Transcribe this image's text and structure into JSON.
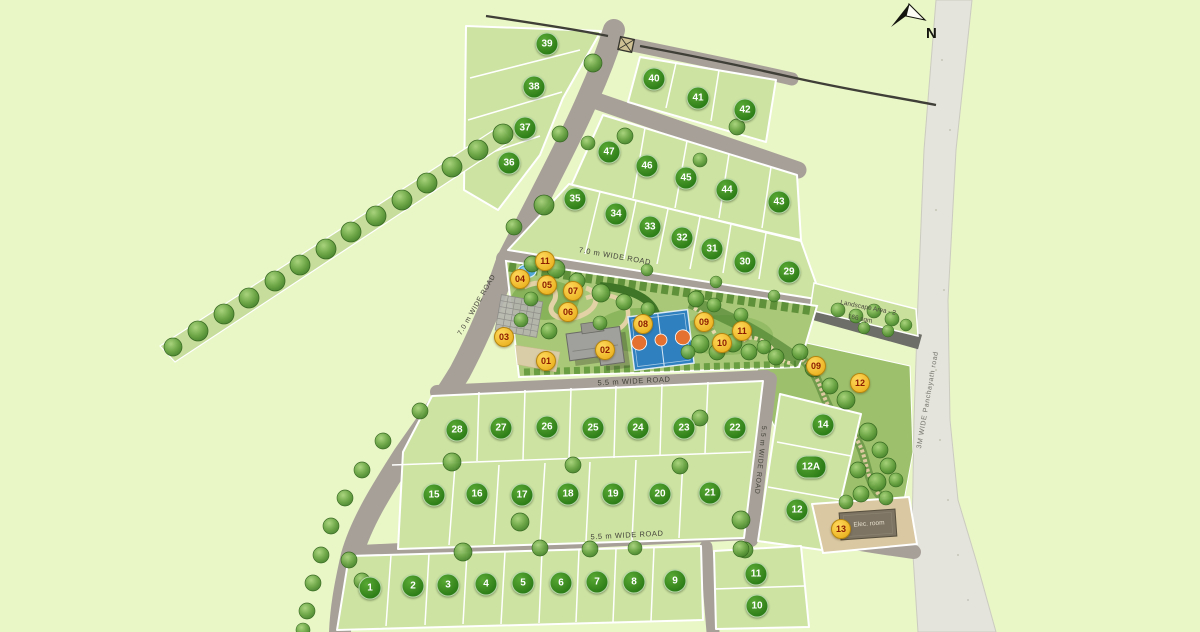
{
  "palette": {
    "background": "#e9f6c6",
    "plot_fill": "#cde3a2",
    "road_fill": "#a7a099",
    "ramp_road_fill": "#6e6e68",
    "panchayath_road_fill": "#e4e4dc",
    "garden_fill": "#a9c878",
    "plot_badge": "#2f8a1d",
    "plot_badge_text": "#ffffff",
    "amenity_badge": "#f0c02e",
    "amenity_badge_text": "#8c1c00",
    "court_blue": "#2f80bf",
    "court_orange": "#e4712f",
    "pond_blue": "#4ea7d8"
  },
  "north": {
    "label": "N"
  },
  "road_labels": [
    {
      "text": "7.0 m WIDE  ROAD",
      "x": 615,
      "y": 256,
      "rot": 10,
      "color": "#44443b",
      "size": 7.5
    },
    {
      "text": "7.0 m WIDE  ROAD",
      "x": 477,
      "y": 305,
      "rot": -60,
      "color": "#44443b",
      "size": 7
    },
    {
      "text": "5.5 m WIDE  ROAD",
      "x": 634,
      "y": 381,
      "rot": -3,
      "color": "#44443b",
      "size": 7.5
    },
    {
      "text": "5.5 m WIDE  ROAD",
      "x": 627,
      "y": 535,
      "rot": -3,
      "color": "#44443b",
      "size": 7.5
    },
    {
      "text": "5.5 m WIDE  ROAD",
      "x": 760,
      "y": 460,
      "rot": 96,
      "color": "#44443b",
      "size": 7
    },
    {
      "text": "3M WIDE  Panchayath road",
      "x": 928,
      "y": 400,
      "rot": -80,
      "color": "#73736b",
      "size": 7
    }
  ],
  "annotations": [
    {
      "text": "Landscape Area - 2",
      "x": 868,
      "y": 308,
      "rot": 11,
      "size": 6.5,
      "color": "#4c4a40"
    },
    {
      "text": "166 sqm",
      "x": 860,
      "y": 319,
      "rot": 11,
      "size": 6.5,
      "color": "#4c4a40"
    },
    {
      "text": "Elec. room",
      "x": 869,
      "y": 524,
      "rot": -4,
      "size": 6.5,
      "color": "#e6decd"
    }
  ],
  "plots": [
    {
      "n": "39",
      "x": 547,
      "y": 44
    },
    {
      "n": "38",
      "x": 534,
      "y": 87
    },
    {
      "n": "37",
      "x": 525,
      "y": 128
    },
    {
      "n": "36",
      "x": 509,
      "y": 163
    },
    {
      "n": "40",
      "x": 654,
      "y": 79
    },
    {
      "n": "41",
      "x": 698,
      "y": 98
    },
    {
      "n": "42",
      "x": 745,
      "y": 110
    },
    {
      "n": "47",
      "x": 609,
      "y": 152
    },
    {
      "n": "46",
      "x": 647,
      "y": 166
    },
    {
      "n": "45",
      "x": 686,
      "y": 178
    },
    {
      "n": "44",
      "x": 727,
      "y": 190
    },
    {
      "n": "43",
      "x": 779,
      "y": 202
    },
    {
      "n": "35",
      "x": 575,
      "y": 199
    },
    {
      "n": "34",
      "x": 616,
      "y": 214
    },
    {
      "n": "33",
      "x": 650,
      "y": 227
    },
    {
      "n": "32",
      "x": 682,
      "y": 238
    },
    {
      "n": "31",
      "x": 712,
      "y": 249
    },
    {
      "n": "30",
      "x": 745,
      "y": 262
    },
    {
      "n": "29",
      "x": 789,
      "y": 272
    },
    {
      "n": "28",
      "x": 457,
      "y": 430
    },
    {
      "n": "27",
      "x": 501,
      "y": 428
    },
    {
      "n": "26",
      "x": 547,
      "y": 427
    },
    {
      "n": "25",
      "x": 593,
      "y": 428
    },
    {
      "n": "24",
      "x": 638,
      "y": 428
    },
    {
      "n": "23",
      "x": 684,
      "y": 428
    },
    {
      "n": "22",
      "x": 735,
      "y": 428
    },
    {
      "n": "14",
      "x": 823,
      "y": 425
    },
    {
      "n": "12A",
      "x": 811,
      "y": 467
    },
    {
      "n": "12",
      "x": 797,
      "y": 510
    },
    {
      "n": "15",
      "x": 434,
      "y": 495
    },
    {
      "n": "16",
      "x": 477,
      "y": 494
    },
    {
      "n": "17",
      "x": 522,
      "y": 495
    },
    {
      "n": "18",
      "x": 568,
      "y": 494
    },
    {
      "n": "19",
      "x": 613,
      "y": 494
    },
    {
      "n": "20",
      "x": 660,
      "y": 494
    },
    {
      "n": "21",
      "x": 710,
      "y": 493
    },
    {
      "n": "1",
      "x": 370,
      "y": 588
    },
    {
      "n": "2",
      "x": 413,
      "y": 586
    },
    {
      "n": "3",
      "x": 448,
      "y": 585
    },
    {
      "n": "4",
      "x": 486,
      "y": 584
    },
    {
      "n": "5",
      "x": 523,
      "y": 583
    },
    {
      "n": "6",
      "x": 561,
      "y": 583
    },
    {
      "n": "7",
      "x": 597,
      "y": 582
    },
    {
      "n": "8",
      "x": 634,
      "y": 582
    },
    {
      "n": "9",
      "x": 675,
      "y": 581
    },
    {
      "n": "11",
      "x": 756,
      "y": 574
    },
    {
      "n": "10",
      "x": 757,
      "y": 606
    }
  ],
  "amenity_markers": [
    {
      "n": "04",
      "x": 520,
      "y": 279
    },
    {
      "n": "11",
      "x": 545,
      "y": 261
    },
    {
      "n": "05",
      "x": 547,
      "y": 285
    },
    {
      "n": "07",
      "x": 573,
      "y": 291
    },
    {
      "n": "06",
      "x": 568,
      "y": 312
    },
    {
      "n": "03",
      "x": 504,
      "y": 337
    },
    {
      "n": "01",
      "x": 546,
      "y": 361
    },
    {
      "n": "02",
      "x": 605,
      "y": 350
    },
    {
      "n": "08",
      "x": 643,
      "y": 324
    },
    {
      "n": "09",
      "x": 704,
      "y": 322
    },
    {
      "n": "10",
      "x": 722,
      "y": 343
    },
    {
      "n": "11",
      "x": 742,
      "y": 331
    },
    {
      "n": "09",
      "x": 816,
      "y": 366
    },
    {
      "n": "12",
      "x": 860,
      "y": 383
    },
    {
      "n": "13",
      "x": 841,
      "y": 529
    }
  ]
}
